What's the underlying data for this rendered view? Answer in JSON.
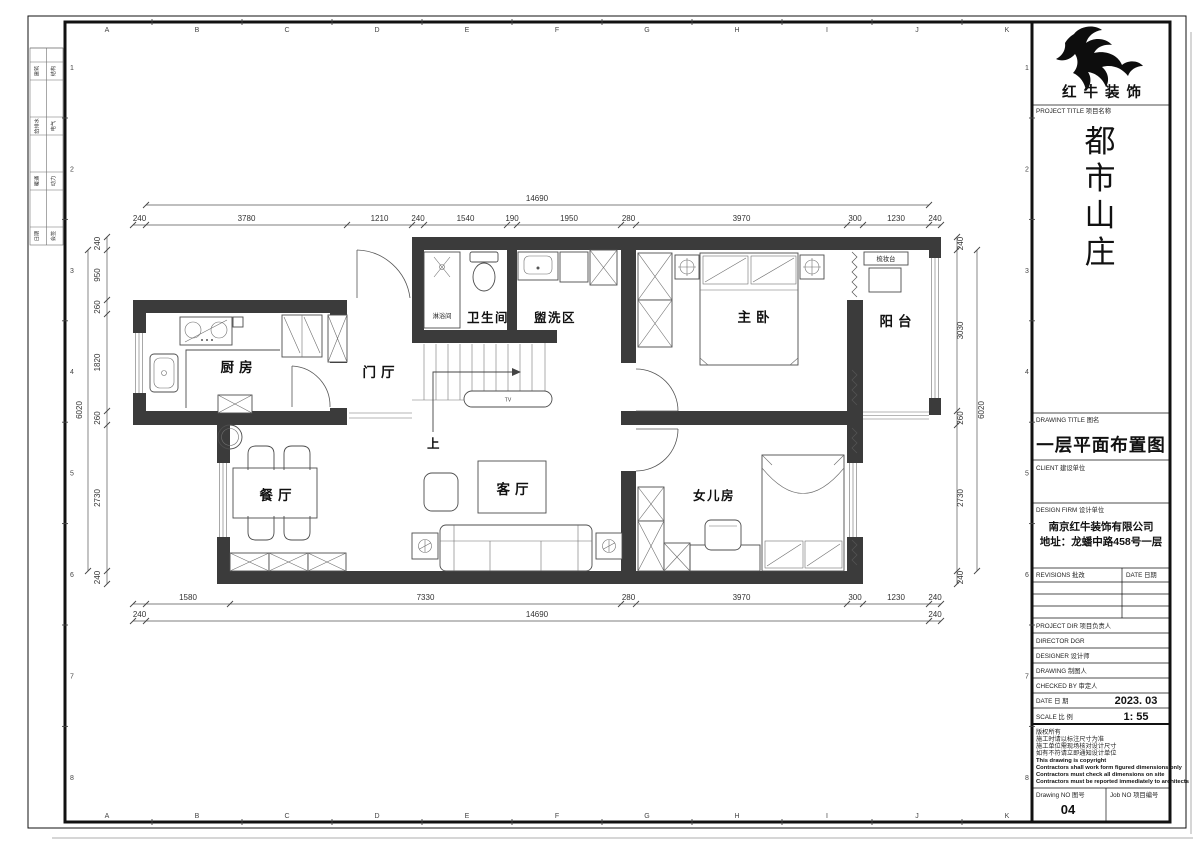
{
  "sheet": {
    "grid_letters": [
      "A",
      "B",
      "C",
      "D",
      "E",
      "F",
      "G",
      "H",
      "I",
      "J",
      "K"
    ],
    "grid_numbers": [
      "1",
      "2",
      "3",
      "4",
      "5",
      "6",
      "7",
      "8"
    ],
    "signature_cells": [
      [
        "建筑",
        "结构"
      ],
      [
        "给排水",
        "电气"
      ],
      [
        "暖通",
        "动力"
      ],
      [
        "日期",
        "会签"
      ]
    ]
  },
  "title_block": {
    "logo_text": "红牛装饰",
    "project_title_label": "PROJECT TITLE  项目名称",
    "project_title": "都市山庄",
    "drawing_title_label": "DRAWING TITLE  图名",
    "drawing_title": "一层平面布置图",
    "client_label": "CLIENT  建设单位",
    "design_firm_label": "DESIGN FIRM  设计单位",
    "design_firm_name": "南京红牛装饰有限公司",
    "design_firm_address": "地址：龙蟠中路458号一层",
    "revisions_label": "REVISIONS  批改",
    "revisions_date_label": "DATE  日期",
    "project_dir_label": "PROJECT DIR   项目负责人",
    "director_label": "DIRECTOR DGR",
    "designer_label": "DESIGNER    设计师",
    "drawing_label": "DRAWING     制图人",
    "checked_by_label": "CHECKED BY  审定人",
    "date_label": "DATE        日  期",
    "date_value": "2023. 03",
    "scale_label": "SCALE       比  例",
    "scale_value": "1:  55",
    "notes": [
      "版权所有",
      "施工时请以标注尺寸为准",
      "施工单位需现场核对设计尺寸",
      "如有不符请立即通知设计单位",
      "This drawing is copyright",
      "Contractors shall work form figured dimensions only",
      "Contractors must check all dimensions on site",
      "Contractors must be reported immediately to architects"
    ],
    "drawing_no_label": "Drawing NO  图号",
    "drawing_no": "04",
    "job_no_label": "Job NO  项目编号"
  },
  "floor_plan": {
    "rooms": {
      "kitchen": "厨房",
      "foyer": "门厅",
      "bathroom": "卫生间",
      "washing": "盥洗区",
      "master_bedroom": "主卧",
      "balcony": "阳台",
      "dining": "餐厅",
      "living": "客厅",
      "daughter_room": "女儿房"
    },
    "annotations": {
      "shower": "淋浴间",
      "dressing_table": "梳妆台",
      "stairs_up": "上",
      "tv": "TV"
    },
    "dimensions": {
      "top_segments": [
        "240",
        "3780",
        "1210",
        "240",
        "1540",
        "190",
        "1950",
        "280",
        "3970",
        "300",
        "1230",
        "240"
      ],
      "top_total": "14690",
      "bottom_segments": [
        "1580",
        "7330",
        "280",
        "3970",
        "300",
        "1230",
        "240"
      ],
      "bottom_total": [
        "240",
        "14690",
        "240"
      ],
      "left_segments": [
        "240",
        "950",
        "260",
        "1820",
        "260",
        "2730",
        "240"
      ],
      "left_total": "6020",
      "right_segments": [
        "240",
        "3030",
        "260",
        "2730",
        "240"
      ],
      "right_total": "6020"
    }
  }
}
